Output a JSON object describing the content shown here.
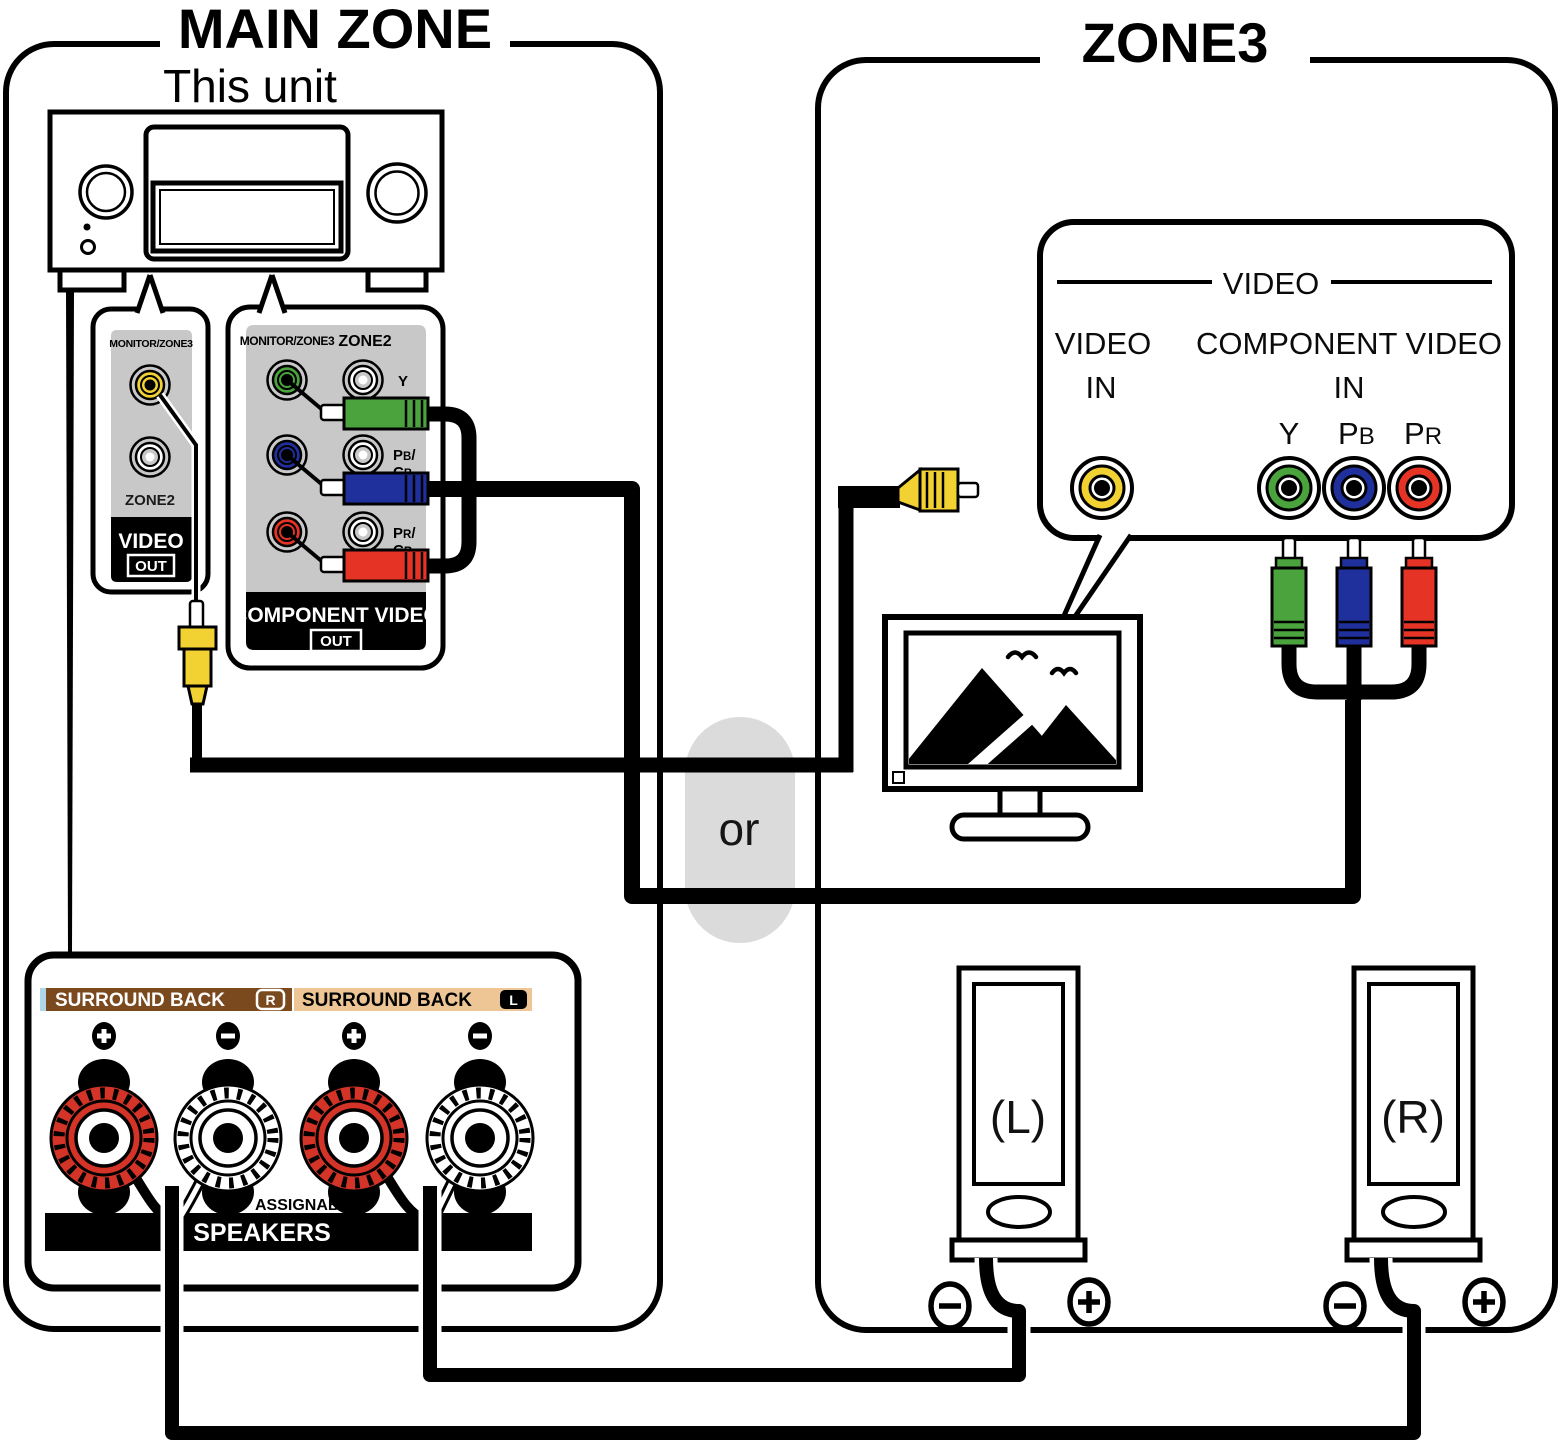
{
  "main_zone": {
    "title": "MAIN ZONE",
    "unit_label": "This unit",
    "video_out_panel": {
      "port_label": "MONITOR/ZONE3",
      "zone2_label": "ZONE2",
      "video": "VIDEO",
      "out": "OUT"
    },
    "component_panel": {
      "monitor_zone3": "MONITOR/ZONE3",
      "zone2": "ZONE2",
      "y": "Y",
      "pb": {
        "p": "P",
        "b": "B",
        "slash": "/"
      },
      "cb": {
        "c": "C",
        "b": "B"
      },
      "pr": {
        "p": "P",
        "r": "R",
        "slash": "/"
      },
      "cr": {
        "c": "C",
        "r": "R"
      },
      "title": "COMPONENT VIDEO",
      "out": "OUT"
    },
    "speaker_panel": {
      "surround_back_r": "SURROUND BACK",
      "r_badge": "R",
      "surround_back_l": "SURROUND BACK",
      "l_badge": "L",
      "plus": "+",
      "minus": "−",
      "assignable": "ASSIGNABLE",
      "speakers": "SPEAKERS"
    }
  },
  "zone3": {
    "title": "ZONE3",
    "video_panel": {
      "header": "VIDEO",
      "video": "VIDEO",
      "in_video": "IN",
      "component_video": "COMPONENT VIDEO",
      "in_component": "IN",
      "y": "Y",
      "pb": {
        "p": "P",
        "b": "B"
      },
      "pr": {
        "p": "P",
        "r": "R"
      }
    },
    "speaker_left": "(L)",
    "speaker_right": "(R)",
    "terminal_minus": "−",
    "terminal_plus": "+"
  },
  "connector": {
    "or_label": "or"
  },
  "colors": {
    "panel_gray": "#c8c8c8",
    "composite_yellow": "#f2d232",
    "component_green": "#4aa33c",
    "component_blue": "#1f2f9b",
    "component_red": "#e53425",
    "post_red": "#d43427",
    "band_brown": "#7a4a1e",
    "band_tan": "#eec695",
    "band_lightblue": "#aed8e8",
    "or_pill": "#dbdbdb"
  }
}
